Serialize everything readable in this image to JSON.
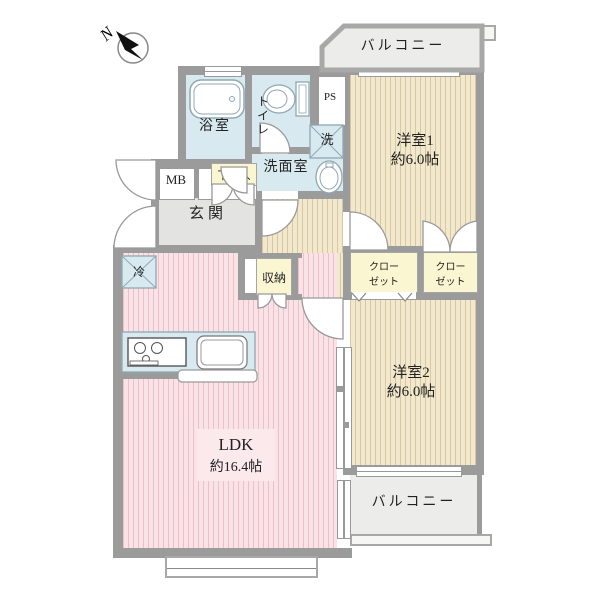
{
  "compass": {
    "label": "N"
  },
  "balconies": {
    "top": "バルコニー",
    "bottom": "バルコニー"
  },
  "rooms": {
    "bathroom": {
      "label": "浴室"
    },
    "toilet": {
      "label": "トイレ"
    },
    "pipe_space": {
      "label": "PS"
    },
    "washer": {
      "label": "洗"
    },
    "washroom": {
      "label": "洗面室"
    },
    "meter_box": {
      "label": "MB"
    },
    "shoe_box": {
      "label": "下足入"
    },
    "entrance": {
      "label": "玄関"
    },
    "storage": {
      "label": "収納"
    },
    "fridge": {
      "label": "冷"
    },
    "closet1": {
      "line1": "クロー",
      "line2": "ゼット"
    },
    "closet2": {
      "line1": "クロー",
      "line2": "ゼット"
    },
    "bedroom1": {
      "name": "洋室1",
      "size": "約6.0帖"
    },
    "bedroom2": {
      "name": "洋室2",
      "size": "約6.0帖"
    },
    "ldk": {
      "name": "LDK",
      "size": "約16.4帖"
    }
  },
  "colors": {
    "wall": "#9b9b9b",
    "water_blue": "#d8eaf0",
    "wood_floor": "#f2e8ce",
    "ldk_pink": "#f9e3e6",
    "balcony": "#ececea",
    "closet_yellow": "#fbf6d2",
    "entrance_gray": "#e3e3e1"
  }
}
